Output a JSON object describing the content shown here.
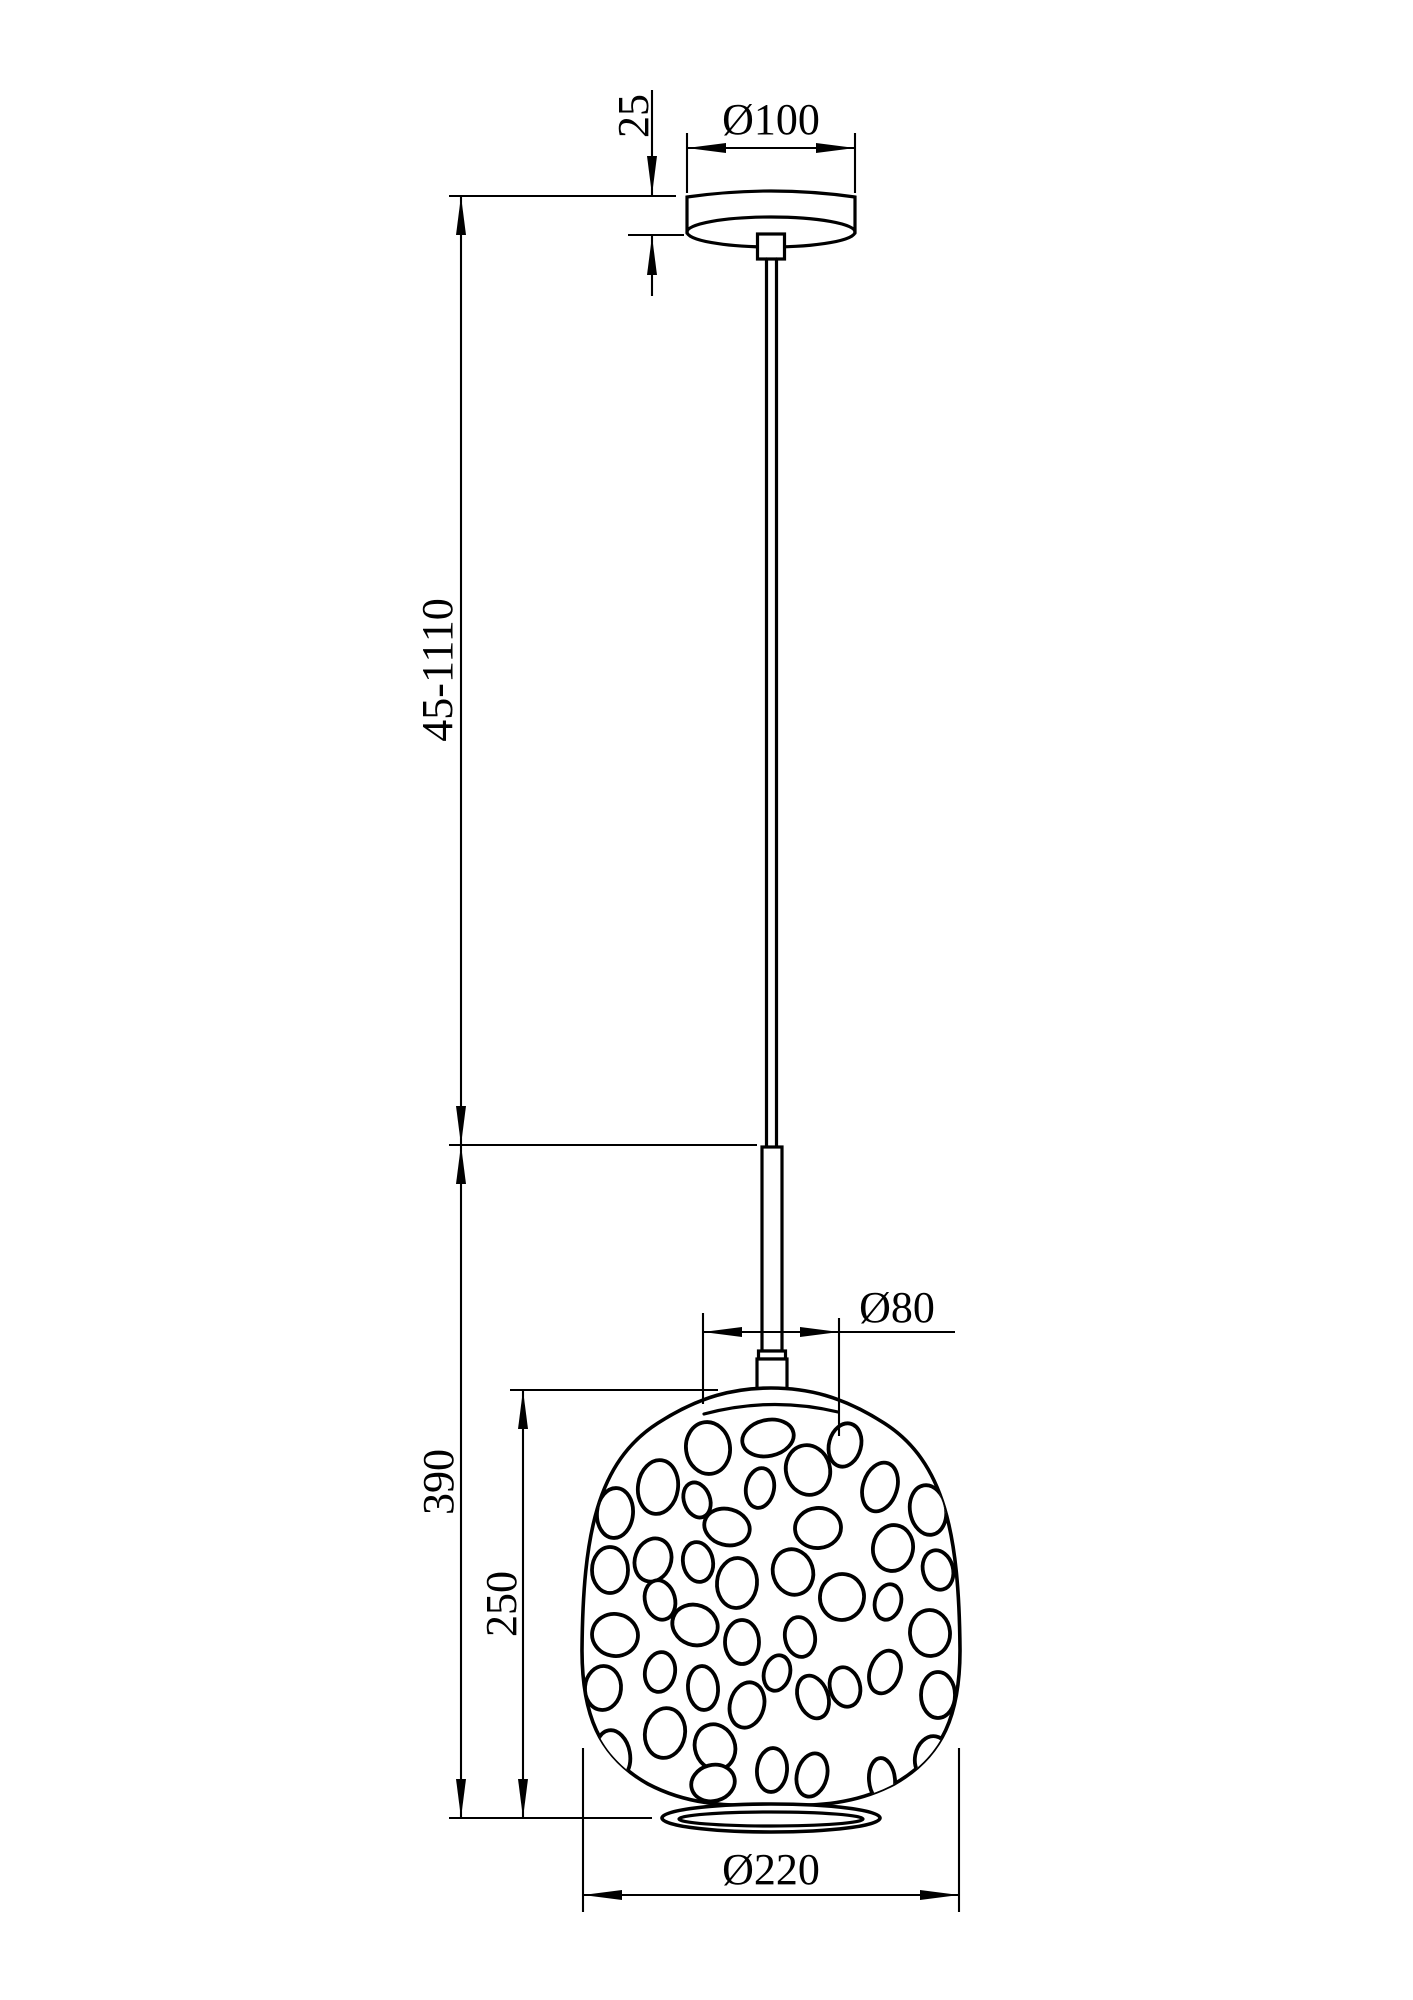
{
  "drawing": {
    "type": "technical-dimension-drawing",
    "subject": "pendant lamp with perforated glass shade",
    "background": "#ffffff",
    "line_color": "#000000",
    "dimensions": {
      "canopy_height": "25",
      "canopy_diameter": "Ø100",
      "suspension_length": "45-1110",
      "shade_total_height": "390",
      "shade_body_height": "250",
      "neck_diameter": "Ø80",
      "shade_diameter": "Ø220"
    },
    "pebbles": [
      {
        "cx": 708,
        "cy": 1448,
        "rx": 22,
        "ry": 26,
        "rot": -8
      },
      {
        "cx": 768,
        "cy": 1438,
        "rx": 26,
        "ry": 18,
        "rot": -12
      },
      {
        "cx": 845,
        "cy": 1445,
        "rx": 16,
        "ry": 22,
        "rot": 15
      },
      {
        "cx": 658,
        "cy": 1487,
        "rx": 20,
        "ry": 27,
        "rot": 8
      },
      {
        "cx": 760,
        "cy": 1488,
        "rx": 14,
        "ry": 20,
        "rot": 10
      },
      {
        "cx": 808,
        "cy": 1470,
        "rx": 22,
        "ry": 25,
        "rot": -15
      },
      {
        "cx": 880,
        "cy": 1487,
        "rx": 17,
        "ry": 25,
        "rot": 18
      },
      {
        "cx": 928,
        "cy": 1510,
        "rx": 18,
        "ry": 25,
        "rot": -10
      },
      {
        "cx": 615,
        "cy": 1513,
        "rx": 18,
        "ry": 25,
        "rot": 5
      },
      {
        "cx": 697,
        "cy": 1500,
        "rx": 13,
        "ry": 18,
        "rot": -20
      },
      {
        "cx": 727,
        "cy": 1527,
        "rx": 23,
        "ry": 18,
        "rot": 15
      },
      {
        "cx": 818,
        "cy": 1528,
        "rx": 23,
        "ry": 20,
        "rot": -5
      },
      {
        "cx": 893,
        "cy": 1548,
        "rx": 20,
        "ry": 23,
        "rot": 10
      },
      {
        "cx": 938,
        "cy": 1570,
        "rx": 15,
        "ry": 20,
        "rot": -15
      },
      {
        "cx": 610,
        "cy": 1570,
        "rx": 18,
        "ry": 23,
        "rot": 0
      },
      {
        "cx": 653,
        "cy": 1560,
        "rx": 18,
        "ry": 22,
        "rot": 20
      },
      {
        "cx": 698,
        "cy": 1562,
        "rx": 15,
        "ry": 20,
        "rot": -10
      },
      {
        "cx": 737,
        "cy": 1583,
        "rx": 20,
        "ry": 25,
        "rot": 5
      },
      {
        "cx": 793,
        "cy": 1572,
        "rx": 20,
        "ry": 23,
        "rot": -18
      },
      {
        "cx": 842,
        "cy": 1597,
        "rx": 22,
        "ry": 23,
        "rot": 10
      },
      {
        "cx": 888,
        "cy": 1602,
        "rx": 13,
        "ry": 18,
        "rot": 15
      },
      {
        "cx": 930,
        "cy": 1633,
        "rx": 20,
        "ry": 23,
        "rot": -5
      },
      {
        "cx": 615,
        "cy": 1635,
        "rx": 23,
        "ry": 21,
        "rot": 10
      },
      {
        "cx": 660,
        "cy": 1600,
        "rx": 15,
        "ry": 20,
        "rot": -15
      },
      {
        "cx": 695,
        "cy": 1625,
        "rx": 23,
        "ry": 20,
        "rot": 20
      },
      {
        "cx": 742,
        "cy": 1642,
        "rx": 17,
        "ry": 22,
        "rot": 0
      },
      {
        "cx": 800,
        "cy": 1637,
        "rx": 15,
        "ry": 20,
        "rot": -10
      },
      {
        "cx": 777,
        "cy": 1673,
        "rx": 13,
        "ry": 18,
        "rot": 15
      },
      {
        "cx": 813,
        "cy": 1697,
        "rx": 15,
        "ry": 22,
        "rot": -20
      },
      {
        "cx": 603,
        "cy": 1688,
        "rx": 18,
        "ry": 22,
        "rot": 5
      },
      {
        "cx": 660,
        "cy": 1672,
        "rx": 15,
        "ry": 20,
        "rot": 10
      },
      {
        "cx": 703,
        "cy": 1688,
        "rx": 15,
        "ry": 22,
        "rot": -5
      },
      {
        "cx": 747,
        "cy": 1705,
        "rx": 17,
        "ry": 23,
        "rot": 15
      },
      {
        "cx": 845,
        "cy": 1687,
        "rx": 15,
        "ry": 20,
        "rot": -15
      },
      {
        "cx": 885,
        "cy": 1672,
        "rx": 15,
        "ry": 22,
        "rot": 20
      },
      {
        "cx": 938,
        "cy": 1695,
        "rx": 17,
        "ry": 23,
        "rot": 0
      },
      {
        "cx": 613,
        "cy": 1755,
        "rx": 17,
        "ry": 25,
        "rot": -10
      },
      {
        "cx": 665,
        "cy": 1733,
        "rx": 20,
        "ry": 25,
        "rot": 10
      },
      {
        "cx": 715,
        "cy": 1747,
        "rx": 20,
        "ry": 23,
        "rot": -20
      },
      {
        "cx": 772,
        "cy": 1770,
        "rx": 15,
        "ry": 22,
        "rot": 5
      },
      {
        "cx": 812,
        "cy": 1775,
        "rx": 15,
        "ry": 22,
        "rot": 15
      },
      {
        "cx": 882,
        "cy": 1780,
        "rx": 13,
        "ry": 22,
        "rot": -5
      },
      {
        "cx": 932,
        "cy": 1758,
        "rx": 17,
        "ry": 22,
        "rot": 10
      },
      {
        "cx": 713,
        "cy": 1783,
        "rx": 22,
        "ry": 18,
        "rot": -15
      }
    ]
  }
}
